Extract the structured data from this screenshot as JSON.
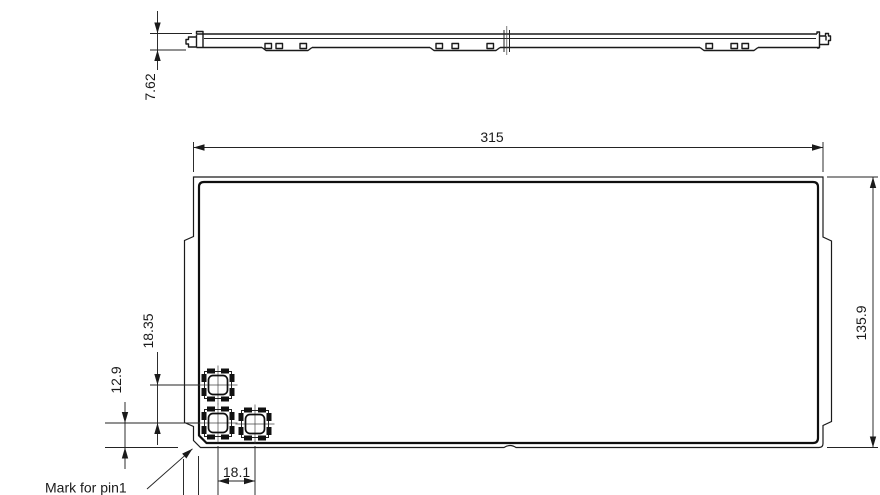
{
  "drawing": {
    "type": "mechanical-dimension-drawing",
    "background": "#ffffff",
    "line_color": "#1a1a1a",
    "views": {
      "side_profile": "side profile view",
      "front": "front view with pin1 pad footprints"
    },
    "dimensions": {
      "profile_thickness": "7.62",
      "body_width": "315",
      "body_height": "135.9",
      "pad_row_spacing": "18.35",
      "pad_bottom_offset": "12.9",
      "pad_column_spacing": "18.1"
    },
    "labels": {
      "pin1_note": "Mark for pin1"
    }
  }
}
